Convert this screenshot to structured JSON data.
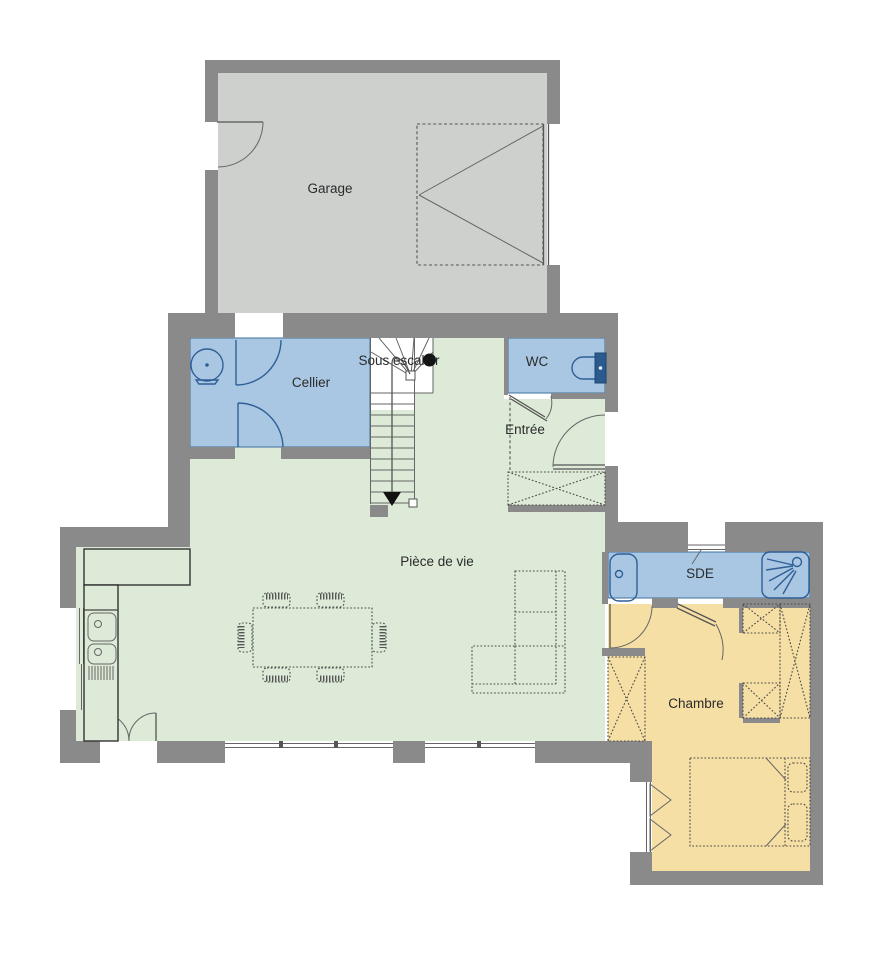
{
  "rooms": {
    "garage": {
      "label": "Garage"
    },
    "cellier": {
      "label": "Cellier"
    },
    "sous_escalier": {
      "label": "Sous escalier"
    },
    "wc": {
      "label": "WC"
    },
    "entree": {
      "label": "Entrée"
    },
    "piece_de_vie": {
      "label": "Pièce de vie"
    },
    "sde": {
      "label": "SDE"
    },
    "chambre": {
      "label": "Chambre"
    }
  },
  "colors": {
    "wall": "#8a8a8a",
    "garage_floor": "#cdd0cd",
    "wet_room_floor": "#a9c7e2",
    "living_floor": "#dcead7",
    "bedroom_floor": "#f6dfa4",
    "fixture_fill": "#bcd4ea",
    "fixture_stroke": "#2f5f96",
    "line": "#555555",
    "text": "#2b2b2b"
  }
}
